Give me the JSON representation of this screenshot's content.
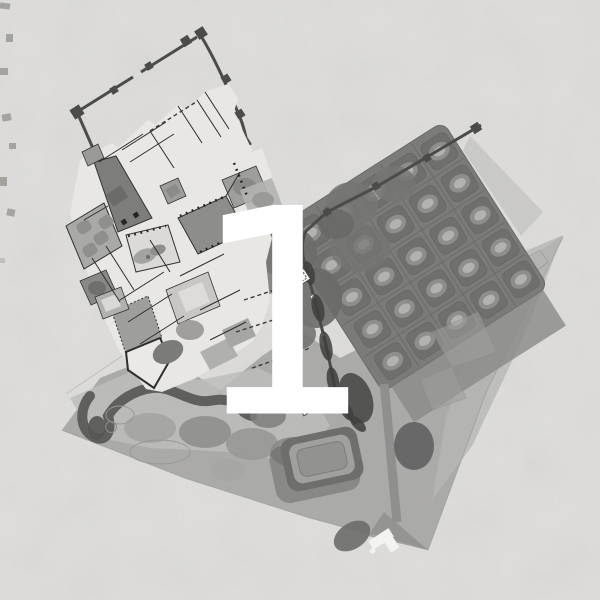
{
  "figure": {
    "number": "1"
  },
  "palette": {
    "paper": "#dedddb",
    "terrace_wash": "#a6a6a4",
    "right_wash": "#b7b7b5",
    "orchard_base": "#7b7b79",
    "orchard_bed": "#6f6f6d",
    "bed_canopy": "#8e8e8c",
    "bed_glow": "#b2b2b0",
    "canopy_dark": "#5a5a58",
    "wall_dark": "#4b4b49",
    "palace_plate": "#e8e7e3",
    "courtyard_gray": "#8d8d8b",
    "pond_light": "#dbdad6",
    "number_white": "#ffffff"
  },
  "regions": [
    "fortified-enclosure-walls",
    "palace-complex",
    "orchard-grid-garden",
    "garden-terrace",
    "tree-canopy-cluster",
    "sunken-garden",
    "pavilions",
    "slide-number"
  ]
}
